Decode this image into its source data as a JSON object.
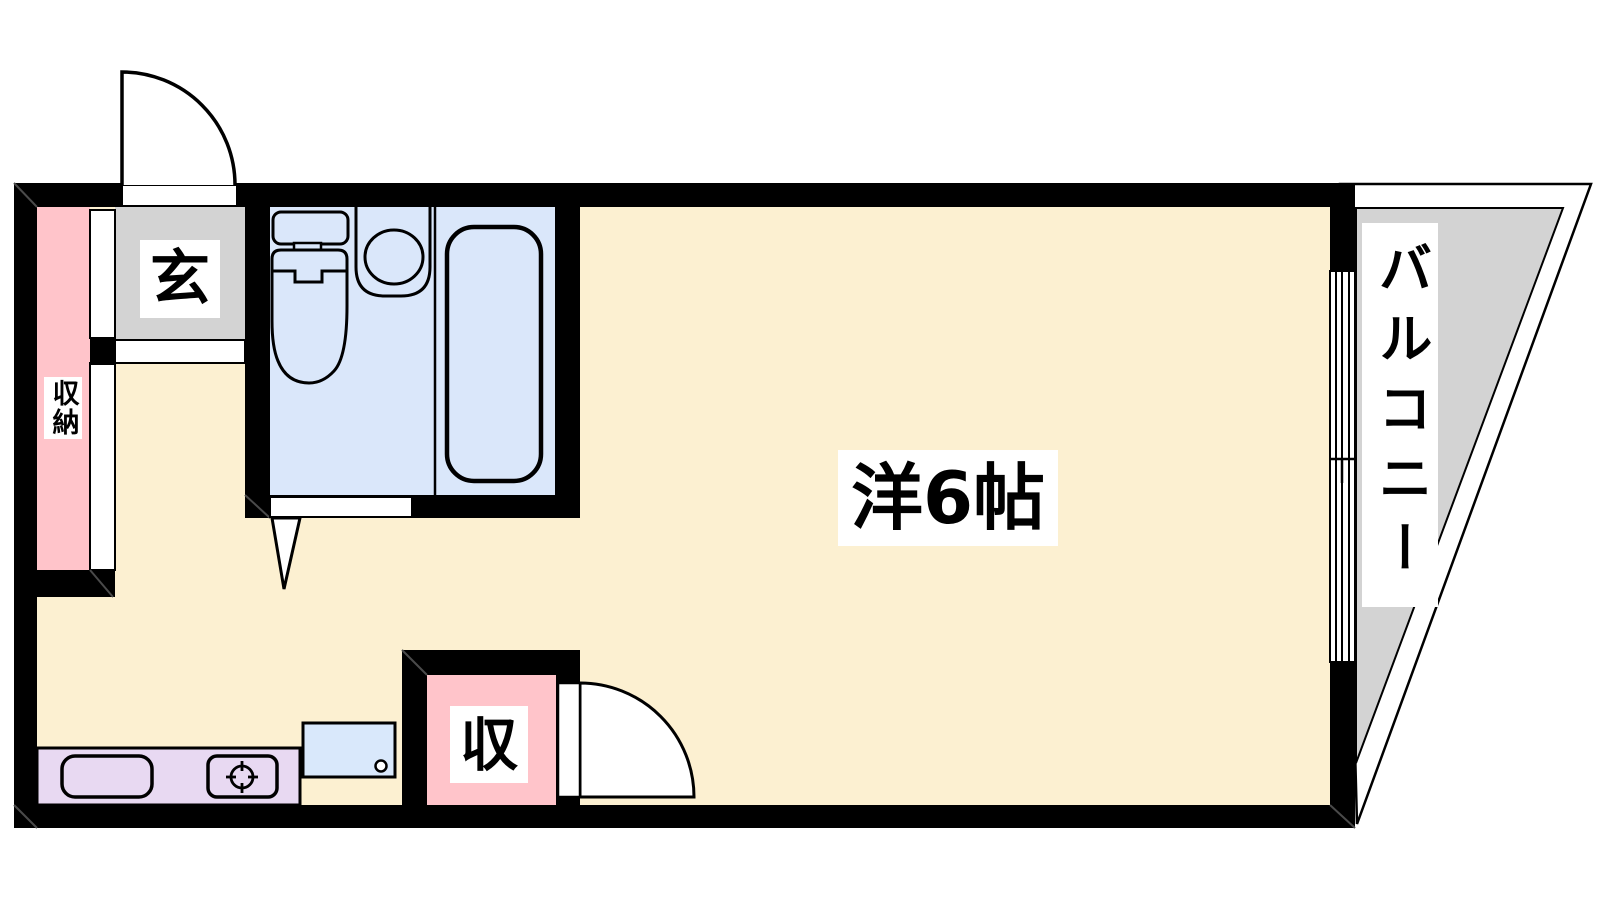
{
  "plan": {
    "type": "apartment-floorplan",
    "rooms": {
      "main_room": {
        "label": "洋6帖"
      },
      "entrance": {
        "label": "玄"
      },
      "closet_left": {
        "label": "収納"
      },
      "closet_bottom": {
        "label": "収"
      },
      "balcony": {
        "label": "バルコニー"
      }
    },
    "fixtures": [
      "entrance-door",
      "toilet",
      "sink",
      "bathtub",
      "bathroom-door",
      "kitchen-sink",
      "stove-burner",
      "washing-machine-pan",
      "room-door",
      "sliding-window"
    ],
    "colors": {
      "wall": "#000000",
      "floor": "#FCF0D1",
      "entrance_tile": "#D3D3D3",
      "balcony_floor": "#D3D3D3",
      "closet": "#FFC4CA",
      "bathroom": "#DAE7FA",
      "kitchen_counter": "#E8D9F2",
      "laundry_pan": "#D9E8FB",
      "label_background": "#FFFFFF",
      "label_text": "#000000"
    }
  }
}
